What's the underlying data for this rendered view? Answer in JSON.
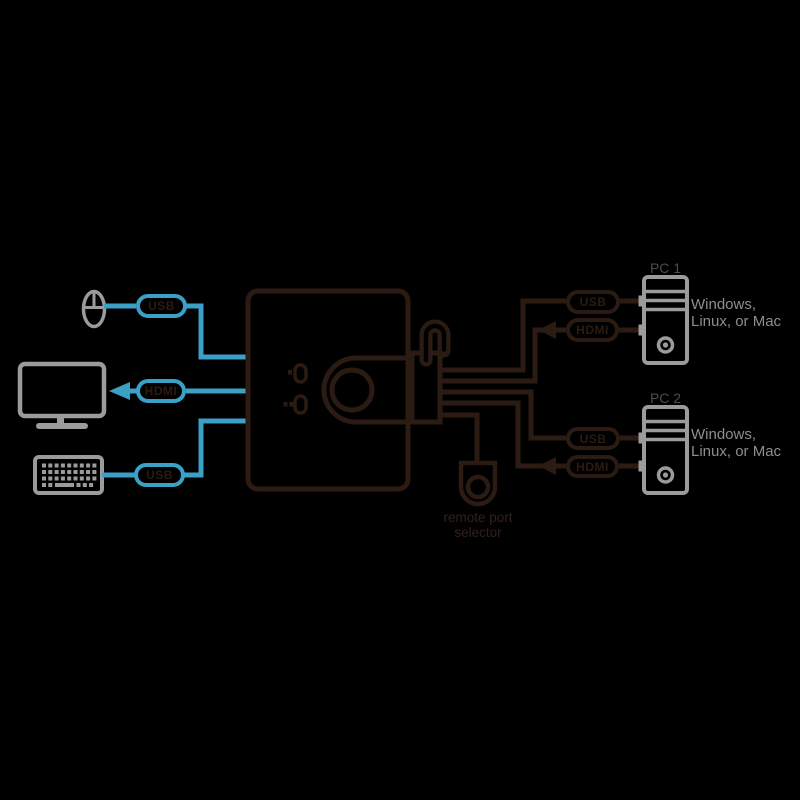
{
  "diagram_title": "KVM switch connection diagram",
  "colors": {
    "background": "#000000",
    "cable_dark": "#2b1b12",
    "cable_blue": "#3aa0c6",
    "device_gray": "#9b9b9b",
    "os_text_gray": "#8d8d8d",
    "pc_name_gray": "#504c4b"
  },
  "console": {
    "mouse_cable_label": "USB",
    "monitor_cable_label": "HDMI",
    "keyboard_cable_label": "USB"
  },
  "switch": {
    "remote_selector_line1": "remote port",
    "remote_selector_line2": "selector"
  },
  "pcs": [
    {
      "name": "PC 1",
      "usb_label": "USB",
      "hdmi_label": "HDMI",
      "os_line1": "Windows,",
      "os_line2": "Linux, or Mac"
    },
    {
      "name": "PC 2",
      "usb_label": "USB",
      "hdmi_label": "HDMI",
      "os_line1": "Windows,",
      "os_line2": "Linux, or Mac"
    }
  ]
}
